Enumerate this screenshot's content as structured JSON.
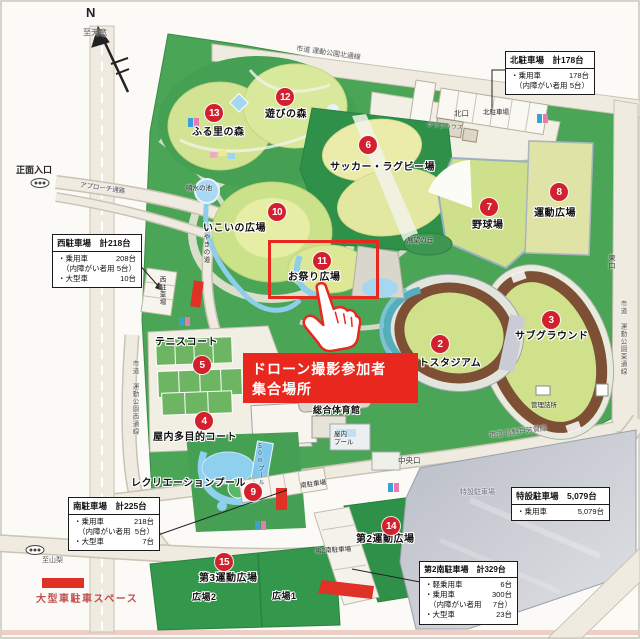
{
  "compass": {
    "n": "N"
  },
  "annotation": {
    "line1": "ドローン撮影参加者",
    "line2": "集合場所"
  },
  "legend": {
    "large_vehicle_space": "大型車駐車スペース"
  },
  "facilities": [
    {
      "num": "2",
      "label": "ソフトスタジアム"
    },
    {
      "num": "3",
      "label": "サブグラウンド"
    },
    {
      "num": "4",
      "label": "屋内多目的コート"
    },
    {
      "num": "5",
      "label": "テニスコート"
    },
    {
      "num": "6",
      "label": "サッカー・ラグビー場"
    },
    {
      "num": "7",
      "label": "野球場"
    },
    {
      "num": "8",
      "label": "運動広場"
    },
    {
      "num": "9",
      "label": "レクリエーションプール"
    },
    {
      "num": "10",
      "label": "いこいの広場"
    },
    {
      "num": "11",
      "label": "お祭り広場"
    },
    {
      "num": "12",
      "label": "遊びの森"
    },
    {
      "num": "13",
      "label": "ふる里の森"
    },
    {
      "num": "14",
      "label": "第2運動広場"
    },
    {
      "num": "15",
      "label": "第3運動広場"
    }
  ],
  "labels": {
    "to_tenryu": "至天竜",
    "to_yamanashi": "至山梨",
    "north_road": "市道 運動公園北通線",
    "west_road": "市道 運動公園西通線",
    "east_road": "市道 運動公園東通線",
    "naganoto_haga_road": "市道 長野戸芳賀線",
    "north_gate": "北口",
    "east_gate": "東口",
    "central_gate": "中央口",
    "main_entrance": "正面入口",
    "approach": "アプローチ通路",
    "keyaki_path": "けやきの道",
    "north_parking": "北駐車場",
    "west_parking": "西駐車場",
    "south_parking": "南駐車場",
    "second_south_parking": "第2南駐車場",
    "special_parking": "特設駐車場",
    "clubhouse": "クラブハウス",
    "fountain_pond": "噴水の池",
    "lookout_hill": "展望の丘",
    "kanri_station": "管理詰所",
    "gym": "総合体育館",
    "indoor_pool": "屋内\nプール",
    "pool_50m": "50mプール",
    "hiroba1": "広場1",
    "hiroba2": "広場2"
  },
  "parking_boxes": {
    "north": {
      "title": "北駐車場　計178台",
      "rows": [
        {
          "label": "・乗用車",
          "value": "178台"
        },
        {
          "label": "（内障がい者用",
          "value": "5台）"
        }
      ]
    },
    "west": {
      "title": "西駐車場　計218台",
      "rows": [
        {
          "label": "・乗用車",
          "value": "208台"
        },
        {
          "label": "（内障がい者用",
          "value": "5台）"
        },
        {
          "label": "・大型車",
          "value": "10台"
        }
      ]
    },
    "south": {
      "title": "南駐車場　計225台",
      "rows": [
        {
          "label": "・乗用車",
          "value": "218台"
        },
        {
          "label": "（内障がい者用",
          "value": "5台）"
        },
        {
          "label": "・大型車",
          "value": "7台"
        }
      ]
    },
    "special": {
      "title": "特設駐車場　5,079台",
      "rows": [
        {
          "label": "・乗用車",
          "value": "5,079台"
        }
      ]
    },
    "second_south": {
      "title": "第2南駐車場　計329台",
      "rows": [
        {
          "label": "・軽乗用車",
          "value": "6台"
        },
        {
          "label": "・乗用車",
          "value": "300台"
        },
        {
          "label": "（内障がい者用",
          "value": "7台）"
        },
        {
          "label": "・大型車",
          "value": "23台"
        }
      ]
    }
  },
  "colors": {
    "highlight_red": "#e8281e",
    "marker_red": "#d2202f",
    "park_green": "#4ba556"
  }
}
